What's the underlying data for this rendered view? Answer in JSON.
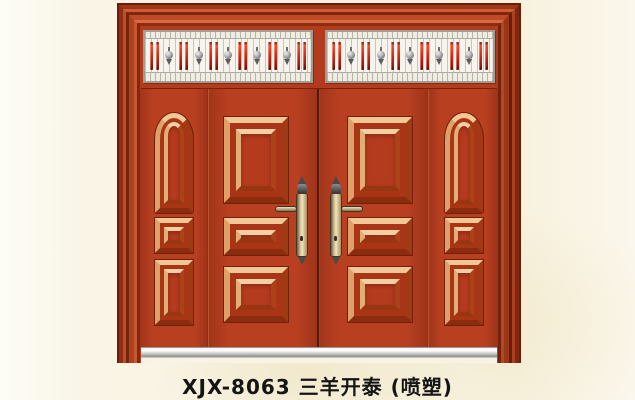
{
  "caption": {
    "full": "XJX-8063 三羊开泰 (喷塑)",
    "model": "XJX-8063",
    "product_name": "三羊开泰",
    "finish": "(喷塑)"
  },
  "door": {
    "type": "double-leaf entrance door with two sidelites and transom grille",
    "colors": {
      "leaf_red": "#b23a1d",
      "frame_highlight": "#d96b40",
      "frame_shadow": "#6a1d0c",
      "panel_molding_highlight": "#f0c795",
      "transom_white": "#f6f4ed",
      "transom_rod_red": "#d02912",
      "ornament_silver": "#9c9c9c",
      "handle_brass": "#d9c79e",
      "sill_silver": "#c2c2c0",
      "background_cream": "#f8f3e3"
    },
    "transom": {
      "panel_count": 2,
      "rod_pairs_per_panel": 6,
      "ornaments_per_panel": 5
    },
    "leaves": {
      "count": 2,
      "panels_per_leaf": [
        "tall-rectangle",
        "wide-rectangle",
        "square"
      ]
    },
    "side_panels": {
      "count": 2,
      "panels_each": [
        "arched-tall",
        "small-square",
        "vertical-rectangle"
      ]
    },
    "handles": {
      "count": 2,
      "style": "lever on ornate vertical plate with finials"
    }
  }
}
